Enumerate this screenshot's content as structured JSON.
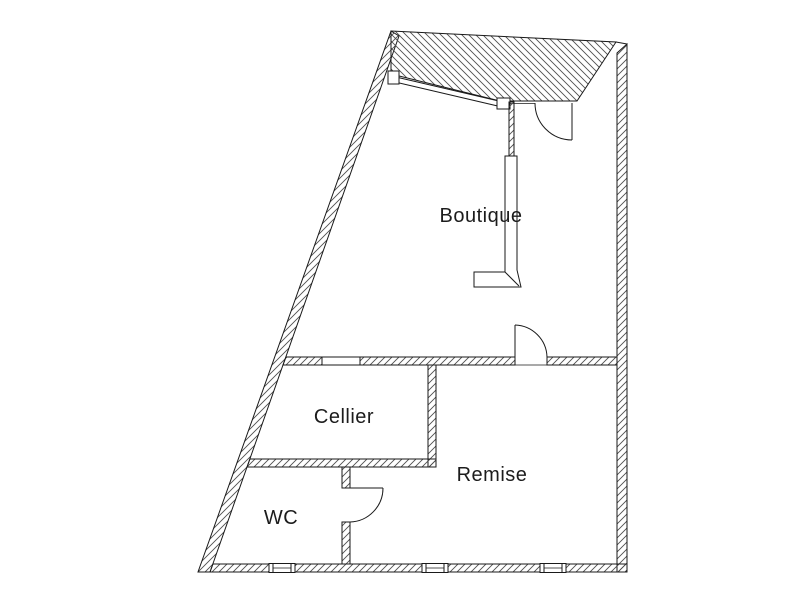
{
  "floor_plan": {
    "rooms": [
      {
        "id": "boutique",
        "label": "Boutique"
      },
      {
        "id": "cellier",
        "label": "Cellier"
      },
      {
        "id": "remise",
        "label": "Remise"
      },
      {
        "id": "wc",
        "label": "WC"
      }
    ],
    "symbols": {
      "door_arcs": 3,
      "bottom_wall_windows": 3,
      "interior_wall_window": 1,
      "storefront_glazing": 1,
      "counter_l_shape": 1
    },
    "colors": {
      "background": "#ffffff",
      "wall_outline": "#1a1a1a",
      "hatch_stroke": "#4f4f4f",
      "label_text": "#1c1c1c"
    }
  }
}
